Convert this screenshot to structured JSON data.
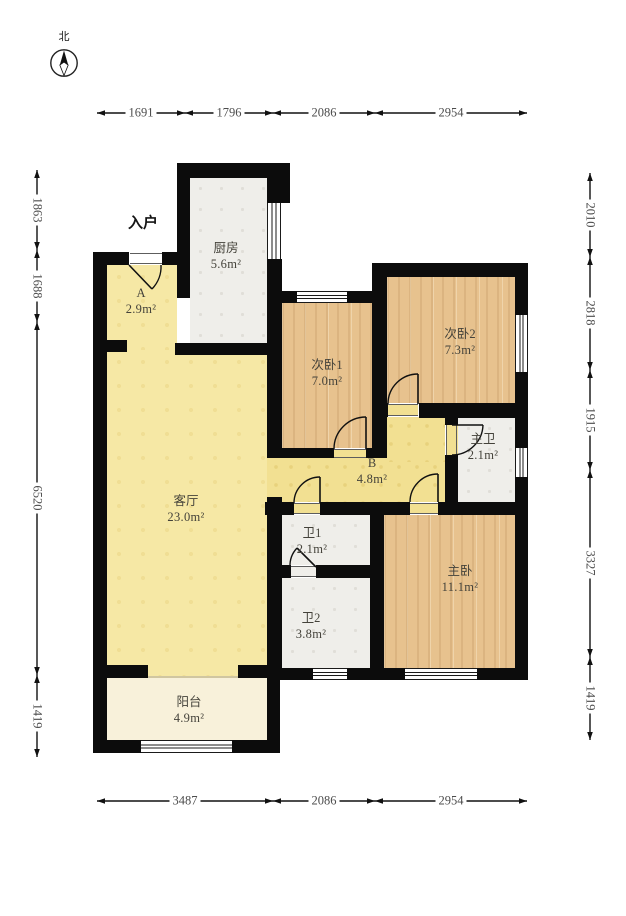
{
  "compass": {
    "north_label": "北"
  },
  "entrance_label": "入户",
  "rooms": [
    {
      "id": "kitchen",
      "name": "厨房",
      "area": "5.6m²"
    },
    {
      "id": "hall-a",
      "name": "A",
      "area": "2.9m²"
    },
    {
      "id": "bedroom2-1",
      "name": "次卧1",
      "area": "7.0m²"
    },
    {
      "id": "bedroom2-2",
      "name": "次卧2",
      "area": "7.3m²"
    },
    {
      "id": "master-bath",
      "name": "主卫",
      "area": "2.1m²"
    },
    {
      "id": "corridor-b",
      "name": "B",
      "area": "4.8m²"
    },
    {
      "id": "living-room",
      "name": "客厅",
      "area": "23.0m²"
    },
    {
      "id": "bath1",
      "name": "卫1",
      "area": "2.1m²"
    },
    {
      "id": "bath2",
      "name": "卫2",
      "area": "3.8m²"
    },
    {
      "id": "master-bedroom",
      "name": "主卧",
      "area": "11.1m²"
    },
    {
      "id": "balcony",
      "name": "阳台",
      "area": "4.9m²"
    }
  ],
  "dimensions": {
    "top": [
      "1691",
      "1796",
      "2086",
      "2954"
    ],
    "bottom": [
      "3487",
      "2086",
      "2954"
    ],
    "left": [
      "1863",
      "1688",
      "6520",
      "1419"
    ],
    "right": [
      "2010",
      "2818",
      "1915",
      "3327",
      "1419"
    ]
  }
}
